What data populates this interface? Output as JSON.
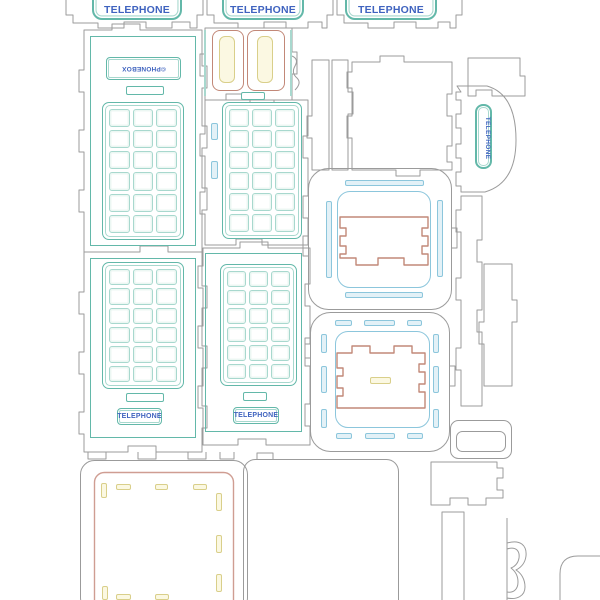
{
  "meta": {
    "description": "Laser-cut template sheet for a telephone box model kit"
  },
  "colors": {
    "outline": "#9b9b9b",
    "teal": "#63b8a9",
    "teal-light": "#a8d8ce",
    "cyan": "#8cc6dc",
    "cyan-fill": "#e3f1f7",
    "red": "#c28878",
    "pink": "#cf9d92",
    "yellow": "#d9cf8a",
    "yellow-fill": "#fbf8e2",
    "text-blue": "#3f63bf"
  },
  "signs": {
    "top": [
      "TELEPHONE",
      "TELEPHONE",
      "TELEPHONE"
    ],
    "door_left": "TELEPHONE",
    "door_mid": "TELEPHONE",
    "side_vertical": "TELEPHONE",
    "brand": "©PHONEBOX"
  },
  "window_grid": {
    "rows": 6,
    "cols": 3
  }
}
